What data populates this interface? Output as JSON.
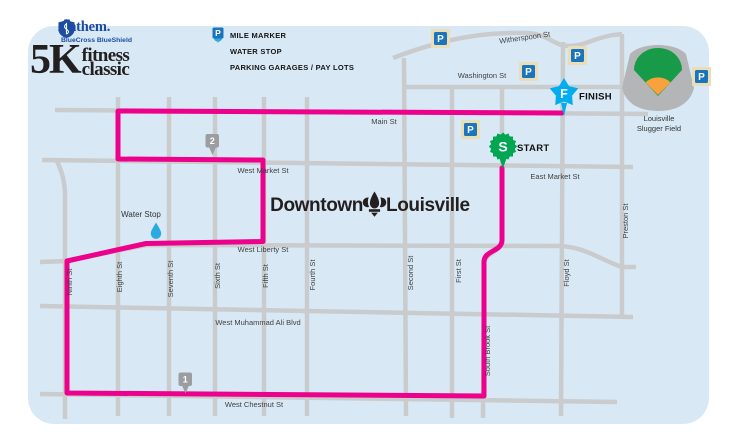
{
  "logo": {
    "brand": "Anthem.",
    "subbrand": "BlueCross BlueShield",
    "event_k": "5K",
    "event_line1": "fitness",
    "event_line2": "classic"
  },
  "legend": {
    "mile_marker": "MILE MARKER",
    "water_stop": "WATER STOP",
    "parking": "PARKING GARAGES / PAY LOTS",
    "parking_letter": "P"
  },
  "map": {
    "title_left": "Downtown",
    "title_right": "Louisville",
    "landmark_line1": "Louisville",
    "landmark_line2": "Slugger Field",
    "start_letter": "S",
    "start_label": "START",
    "finish_letter": "F",
    "finish_label": "FINISH",
    "water_stop_label": "Water Stop",
    "mile_marker_1": "1",
    "mile_marker_2": "2",
    "parking_letter": "P",
    "streets": {
      "witherspoon": "Witherspoon St",
      "washington": "Washington St",
      "main": "Main St",
      "west_market": "West Market St",
      "east_market": "East Market St",
      "west_liberty": "West Liberty St",
      "muhammad_ali": "West Muhammad Ali Blvd",
      "west_chestnut": "West Chestnut St",
      "ninth": "Ninth St",
      "eighth": "Eighth St",
      "seventh": "Seventh St",
      "sixth": "Sixth St",
      "fifth": "Fifth St",
      "fourth": "Fourth St",
      "second": "Second St",
      "first": "First St",
      "south_brook": "South Brook St",
      "floyd": "Floyd St",
      "preston": "Preston St"
    }
  },
  "colors": {
    "route_pink": "#ec008c",
    "street_gray": "#c9cbcd",
    "map_bg": "#d8e9f5",
    "start_green": "#00a651",
    "finish_cyan": "#00aeef",
    "parking_blue": "#1b75bc",
    "parking_tan": "#e9deb5",
    "mile_marker_gray": "#9b9da0",
    "water_drop_blue": "#29abe2",
    "brand_blue": "#1c4da1"
  }
}
